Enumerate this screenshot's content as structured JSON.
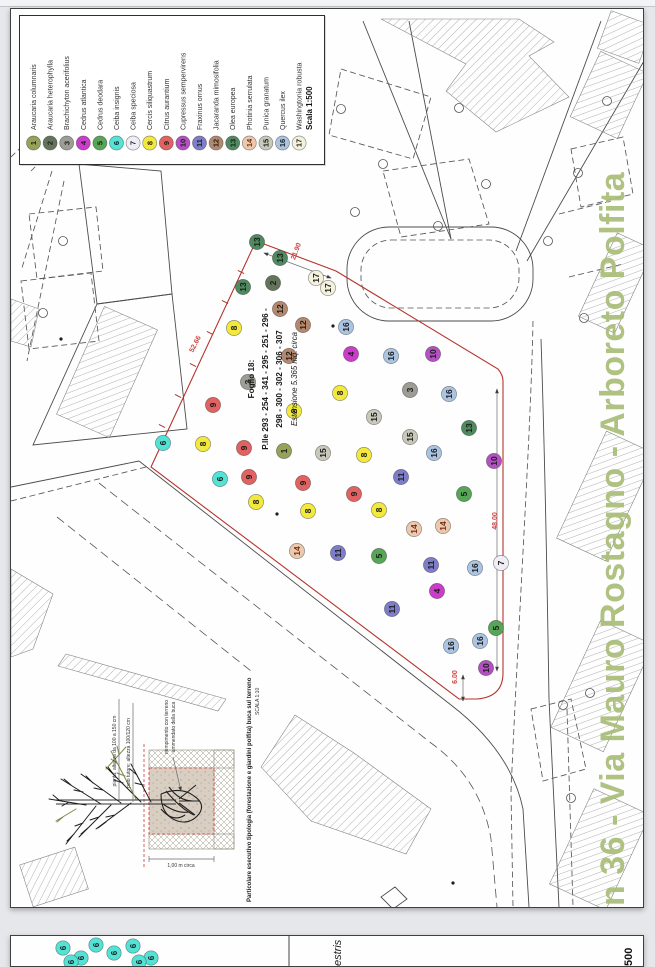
{
  "title": {
    "text": "n 36 - Via Mauro Rostagno - Arboreto Polfita",
    "color": "#a9bd78"
  },
  "legend": {
    "scale_label": "Scala 1:500",
    "species": [
      {
        "n": 1,
        "name": "Araucaria columnaris",
        "color": "#96a257"
      },
      {
        "n": 2,
        "name": "Araucaria heterophylla",
        "color": "#64745a"
      },
      {
        "n": 3,
        "name": "Brachichyton acerifolius",
        "color": "#9d9d95"
      },
      {
        "n": 4,
        "name": "Cedrus atlantica",
        "color": "#cb3ccb"
      },
      {
        "n": 5,
        "name": "Cedrus deodara",
        "color": "#57a657"
      },
      {
        "n": 6,
        "name": "Ceiba insignis",
        "color": "#52e2d6"
      },
      {
        "n": 7,
        "name": "Ceiba speciosa",
        "color": "#f1edf6"
      },
      {
        "n": 8,
        "name": "Cercis siliquastrum",
        "color": "#f2e93c"
      },
      {
        "n": 9,
        "name": "Citrus aurantium",
        "color": "#e26161"
      },
      {
        "n": 10,
        "name": "Cupressus sempervirens",
        "color": "#b54fc4"
      },
      {
        "n": 11,
        "name": "Fraxinus ornus",
        "color": "#7d7dc9"
      },
      {
        "n": 12,
        "name": "Jacaranda mimosifolia",
        "color": "#b5886d"
      },
      {
        "n": 13,
        "name": "Olea europea",
        "color": "#4f8a61"
      },
      {
        "n": 14,
        "name": "Photinia serrulata",
        "color": "#eac9ad",
        "num": "#7a2a1a"
      },
      {
        "n": 15,
        "name": "Punica granatum",
        "color": "#c8c8bb"
      },
      {
        "n": 16,
        "name": "Quercus ilex",
        "color": "#abc4e2"
      },
      {
        "n": 17,
        "name": "Washingtonia robusta",
        "color": "#f4f1dc"
      }
    ]
  },
  "map": {
    "center_label": {
      "l1": "Foglio 18:",
      "l2": "P.lle 293 - 254 - 341 - 295 - 251 - 296 -",
      "l3": "298 - 300 - 302 - 306 - 307",
      "l4": "Estensione 5.365 mq. circa"
    },
    "dims": [
      {
        "text": "52.66"
      },
      {
        "text": "21.90"
      },
      {
        "text": "48.00"
      },
      {
        "text": "6.00"
      }
    ],
    "trees": [
      {
        "n": 13,
        "x": 246,
        "y": 233
      },
      {
        "n": 13,
        "x": 269,
        "y": 249
      },
      {
        "n": 13,
        "x": 232,
        "y": 278
      },
      {
        "n": 2,
        "x": 262,
        "y": 274
      },
      {
        "n": 17,
        "x": 305,
        "y": 269
      },
      {
        "n": 17,
        "x": 317,
        "y": 279
      },
      {
        "n": 12,
        "x": 269,
        "y": 300
      },
      {
        "n": 12,
        "x": 292,
        "y": 316
      },
      {
        "n": 8,
        "x": 223,
        "y": 319
      },
      {
        "n": 16,
        "x": 335,
        "y": 318
      },
      {
        "n": 4,
        "x": 340,
        "y": 345
      },
      {
        "n": 12,
        "x": 278,
        "y": 347
      },
      {
        "n": 16,
        "x": 380,
        "y": 347
      },
      {
        "n": 10,
        "x": 422,
        "y": 345
      },
      {
        "n": 3,
        "x": 237,
        "y": 373
      },
      {
        "n": 8,
        "x": 329,
        "y": 384
      },
      {
        "n": 3,
        "x": 399,
        "y": 381
      },
      {
        "n": 16,
        "x": 438,
        "y": 385
      },
      {
        "n": 9,
        "x": 202,
        "y": 396
      },
      {
        "n": 8,
        "x": 283,
        "y": 402
      },
      {
        "n": 15,
        "x": 363,
        "y": 408
      },
      {
        "n": 13,
        "x": 458,
        "y": 419
      },
      {
        "n": 15,
        "x": 399,
        "y": 428
      },
      {
        "n": 6,
        "x": 152,
        "y": 434
      },
      {
        "n": 8,
        "x": 192,
        "y": 435
      },
      {
        "n": 9,
        "x": 233,
        "y": 439
      },
      {
        "n": 1,
        "x": 273,
        "y": 442
      },
      {
        "n": 15,
        "x": 312,
        "y": 444
      },
      {
        "n": 8,
        "x": 353,
        "y": 446
      },
      {
        "n": 16,
        "x": 423,
        "y": 444
      },
      {
        "n": 10,
        "x": 483,
        "y": 452
      },
      {
        "n": 6,
        "x": 209,
        "y": 470
      },
      {
        "n": 9,
        "x": 238,
        "y": 468
      },
      {
        "n": 9,
        "x": 292,
        "y": 474
      },
      {
        "n": 11,
        "x": 390,
        "y": 468
      },
      {
        "n": 8,
        "x": 245,
        "y": 493
      },
      {
        "n": 9,
        "x": 343,
        "y": 485
      },
      {
        "n": 5,
        "x": 453,
        "y": 485
      },
      {
        "n": 8,
        "x": 297,
        "y": 502
      },
      {
        "n": 8,
        "x": 368,
        "y": 501
      },
      {
        "n": 14,
        "x": 403,
        "y": 520
      },
      {
        "n": 14,
        "x": 432,
        "y": 517
      },
      {
        "n": 14,
        "x": 286,
        "y": 542
      },
      {
        "n": 11,
        "x": 327,
        "y": 544
      },
      {
        "n": 5,
        "x": 368,
        "y": 547
      },
      {
        "n": 11,
        "x": 420,
        "y": 556
      },
      {
        "n": 16,
        "x": 464,
        "y": 559
      },
      {
        "n": 7,
        "x": 490,
        "y": 554
      },
      {
        "n": 4,
        "x": 426,
        "y": 582
      },
      {
        "n": 11,
        "x": 381,
        "y": 600
      },
      {
        "n": 5,
        "x": 485,
        "y": 619
      },
      {
        "n": 16,
        "x": 440,
        "y": 637
      },
      {
        "n": 16,
        "x": 469,
        "y": 632
      },
      {
        "n": 10,
        "x": 475,
        "y": 659
      }
    ]
  },
  "detail": {
    "label1": "pianta: altezza da 100 a 150 cm",
    "label2": "palo tutore: altezza 100/120 cm",
    "label3a": "riempimento con terreno",
    "label3b": "ammendato della buca",
    "dim_bottom": "1,00 m circa",
    "caption": "Particolare esecutivo tipologia (forestazione e giardini polfita) buca sul terreno",
    "caption_scale": "SCALA 1:10"
  },
  "sheet2": {
    "fragment_species": "estris",
    "fragment_scale": "500",
    "trees": [
      {
        "n": 6,
        "x": 52,
        "y": 12
      },
      {
        "n": 6,
        "x": 70,
        "y": 22
      },
      {
        "n": 6,
        "x": 85,
        "y": 9
      },
      {
        "n": 6,
        "x": 103,
        "y": 17
      },
      {
        "n": 6,
        "x": 122,
        "y": 10
      },
      {
        "n": 6,
        "x": 140,
        "y": 22
      },
      {
        "n": 6,
        "x": 60,
        "y": 26
      },
      {
        "n": 6,
        "x": 128,
        "y": 26
      }
    ]
  }
}
